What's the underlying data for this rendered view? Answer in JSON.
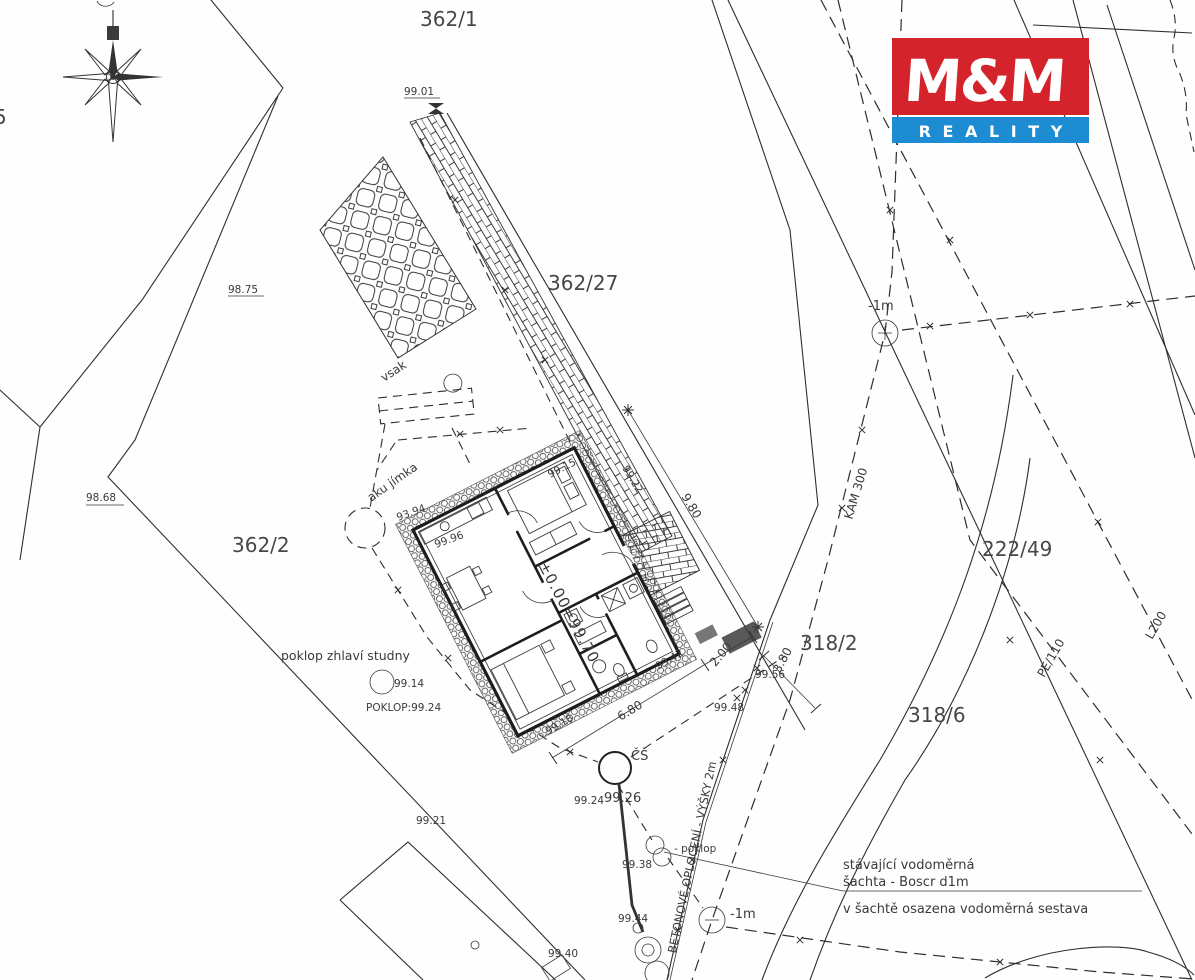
{
  "logo": {
    "mm": "M&M",
    "reality": "R E A L I T Y",
    "red": "#d5232b",
    "blue": "#1d8cd3"
  },
  "parcels": {
    "p362_1": "362/1",
    "p362_27": "362/27",
    "p362_2": "362/2",
    "p318_2": "318/2",
    "p318_6": "318/6",
    "p222_49": "222/49"
  },
  "utilities": {
    "kam": "KAM 300",
    "pe": "PE/110",
    "l200": "L200",
    "fence": "BETONOVÉ OPLOCENÍ - VÝŠKY 2m",
    "minus1m_top": "-1m",
    "minus1m_bottom": "-1m"
  },
  "features": {
    "vsak": "vsak",
    "aku_jimka": "aku jímka",
    "well_caption": "poklop zhlaví studny",
    "well_cover": "POKLOP:99.24",
    "cs_shaft": "ČŠ",
    "poklop_callout": "- poklop",
    "shaft_line1": "stávající vodoměrná",
    "shaft_line2": "šachta - Boscr d1m",
    "shaft_line3": "v šachtě osazena vodoměrná sestava",
    "zero_level": "±0.00=99.70",
    "edge_digit": "5"
  },
  "dimensions": {
    "d980": "9.80",
    "d680": "6.80",
    "d200": "2.00",
    "d380": "3.80"
  },
  "elevations": {
    "e9901": "99.01",
    "e9875": "98.75",
    "e9868": "98.68",
    "e9922": "99.22",
    "e9915": "99.15",
    "e9394": "93.94",
    "e9996": "99.96",
    "e9914": "99.14",
    "e9918": "99.18",
    "e9942": "99.42",
    "e9948": "99.48",
    "e9956": "99.56",
    "e9924": "99.24",
    "e9926": "99.26",
    "e9921": "99.21",
    "e9938": "99.38",
    "e9944": "99.44",
    "e9940": "99.40"
  }
}
